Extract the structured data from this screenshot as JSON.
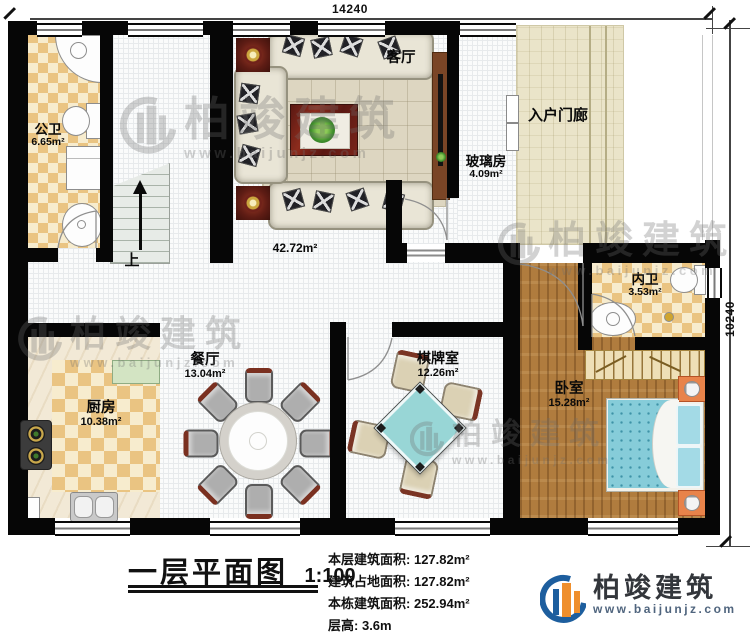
{
  "dimensions": {
    "top": "14240",
    "right": "10240"
  },
  "rooms": {
    "gongwei": {
      "name": "公卫",
      "area": "6.65m²"
    },
    "keting": {
      "name": "客厅",
      "area": "42.72m²"
    },
    "boli": {
      "name": "玻璃房",
      "area": "4.09m²"
    },
    "menlang": {
      "name": "入户门廊"
    },
    "neiwei": {
      "name": "内卫",
      "area": "3.53m²"
    },
    "canting": {
      "name": "餐厅",
      "area": "13.04m²"
    },
    "chufang": {
      "name": "厨房",
      "area": "10.38m²"
    },
    "qipai": {
      "name": "棋牌室",
      "area": "12.26m²"
    },
    "woshi": {
      "name": "卧室",
      "area": "15.28m²"
    }
  },
  "stairs": {
    "up_label": "上"
  },
  "title_block": {
    "title": "一层平面图",
    "scale": "1:100",
    "stats": [
      {
        "label": "本层建筑面积:",
        "value": "127.82m²"
      },
      {
        "label": "建筑占地面积:",
        "value": "127.82m²"
      },
      {
        "label": "本栋建筑面积:",
        "value": "252.94m²"
      },
      {
        "label": "层高:",
        "value": "3.6m"
      }
    ]
  },
  "logo": {
    "name": "柏竣建筑",
    "website": "www.baijunjz.com"
  },
  "watermark": {
    "name": "柏竣建筑",
    "website": "www.baijunjz.com"
  },
  "colors": {
    "wall": "#060606",
    "checker_tan": "#eac482",
    "wood": "#b07c3e",
    "porch": "#eae4c9",
    "bed_blue": "#86ccd9",
    "card_table": "#98d6d6",
    "logo_blue": "#1d5e9e",
    "logo_orange": "#ef8f2d"
  }
}
